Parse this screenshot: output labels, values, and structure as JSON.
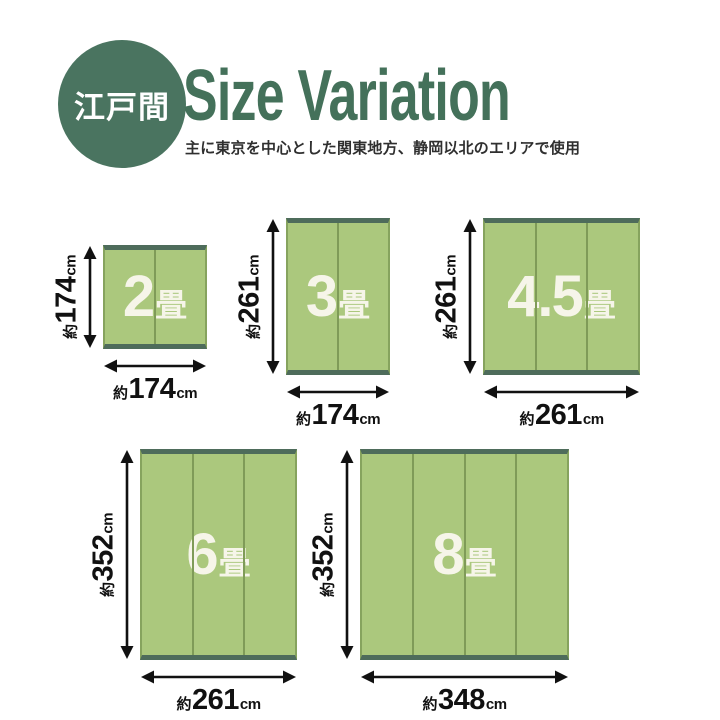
{
  "header": {
    "badge_label": "江戸間",
    "title": "Size Variation",
    "subtitle": "主に東京を中心とした関東地方、静岡以北のエリアで使用"
  },
  "colors": {
    "badge_green": "#4a7460",
    "title_green": "#44715a",
    "rug_fill": "#abc87d",
    "rug_divider": "#7f9b58",
    "rug_side_edge": "#86a35e",
    "rug_end_edge": "#4e6c5b",
    "rug_label_text": "#f6f5e9",
    "dimension_text": "#111111"
  },
  "diagram": {
    "rugs": [
      {
        "id": "2jo",
        "size_number": "2",
        "size_unit": "畳",
        "panels": 2,
        "width_cm": 174,
        "height_cm": 174,
        "width_label": {
          "prefix": "約",
          "value": "174",
          "unit": "cm"
        },
        "height_label": {
          "prefix": "約",
          "value": "174",
          "unit": "cm"
        }
      },
      {
        "id": "3jo",
        "size_number": "3",
        "size_unit": "畳",
        "panels": 2,
        "width_cm": 174,
        "height_cm": 261,
        "width_label": {
          "prefix": "約",
          "value": "174",
          "unit": "cm"
        },
        "height_label": {
          "prefix": "約",
          "value": "261",
          "unit": "cm"
        }
      },
      {
        "id": "4-5jo",
        "size_number": "4.5",
        "size_unit": "畳",
        "panels": 3,
        "width_cm": 261,
        "height_cm": 261,
        "width_label": {
          "prefix": "約",
          "value": "261",
          "unit": "cm"
        },
        "height_label": {
          "prefix": "約",
          "value": "261",
          "unit": "cm"
        }
      },
      {
        "id": "6jo",
        "size_number": "6",
        "size_unit": "畳",
        "panels": 3,
        "width_cm": 261,
        "height_cm": 352,
        "width_label": {
          "prefix": "約",
          "value": "261",
          "unit": "cm"
        },
        "height_label": {
          "prefix": "約",
          "value": "352",
          "unit": "cm"
        }
      },
      {
        "id": "8jo",
        "size_number": "8",
        "size_unit": "畳",
        "panels": 4,
        "width_cm": 348,
        "height_cm": 352,
        "width_label": {
          "prefix": "約",
          "value": "348",
          "unit": "cm"
        },
        "height_label": {
          "prefix": "約",
          "value": "352",
          "unit": "cm"
        }
      }
    ]
  }
}
